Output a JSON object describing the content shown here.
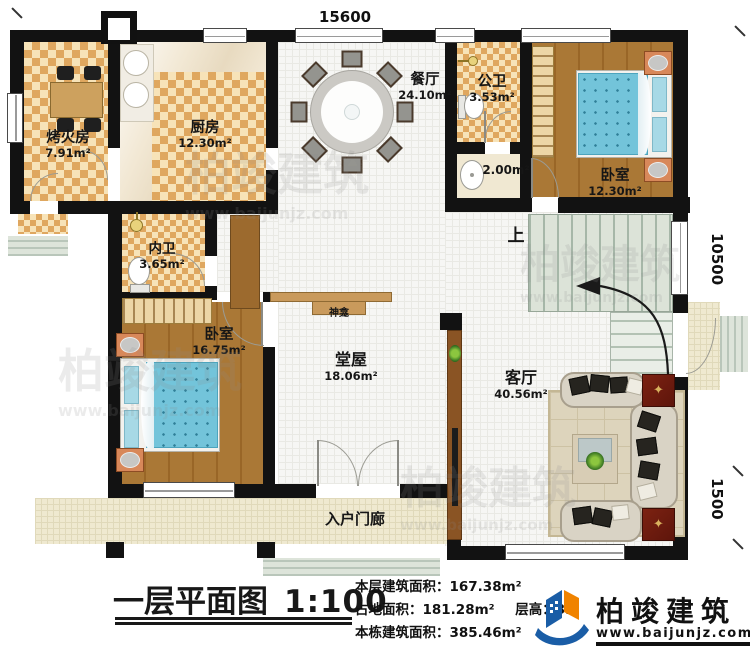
{
  "dimensions": {
    "width_top": "15600",
    "depth_right": "10500",
    "porch_right": "1500"
  },
  "rooms": {
    "kaohuofang": {
      "name": "烤火房",
      "area": "7.91m²"
    },
    "chufang": {
      "name": "厨房",
      "area": "12.30m²"
    },
    "canting": {
      "name": "餐厅",
      "area": "24.10m²"
    },
    "gongwei": {
      "name": "公卫",
      "area": "3.53m²"
    },
    "xishou": {
      "area": "2.00m²"
    },
    "woshi_tr": {
      "name": "卧室",
      "area": "12.30m²"
    },
    "neiwei": {
      "name": "内卫",
      "area": "3.65m²"
    },
    "woshi_bl": {
      "name": "卧室",
      "area": "16.75m²"
    },
    "tangwu": {
      "name": "堂屋",
      "area": "18.06m²"
    },
    "shenkan": {
      "name": "神龛"
    },
    "keting": {
      "name": "客厅",
      "area": "40.56m²"
    },
    "menlang": {
      "name": "入户门廊"
    },
    "stairs": {
      "direction": "上"
    }
  },
  "title_block": {
    "title": "一层平面图",
    "scale": "1:100",
    "stat1": "本层建筑面积：167.38m²",
    "stat2a": "占地面积：181.28m²",
    "stat2b": "层高：3.6",
    "stat3": "本栋建筑面积：385.46m²"
  },
  "brand": {
    "name": "柏竣建筑",
    "url": "www.baijunjz.com"
  },
  "watermark": {
    "name": "柏竣建筑",
    "url": "www.baijunjz.com"
  },
  "icons": {
    "side_table_star": "✦"
  },
  "colors": {
    "wall": "#121212",
    "checker_dark": "#dfa75f",
    "checker_light": "#f7e3b8",
    "wood_dark": "#996627",
    "wood_light": "#aa7836",
    "bed": "#73c4da",
    "bed_dot": "#2f7f98",
    "stairs": "#dce3d8",
    "rug": "#ddd4bc",
    "brand_blue": "#1a5da6",
    "brand_orange": "#f08300"
  }
}
